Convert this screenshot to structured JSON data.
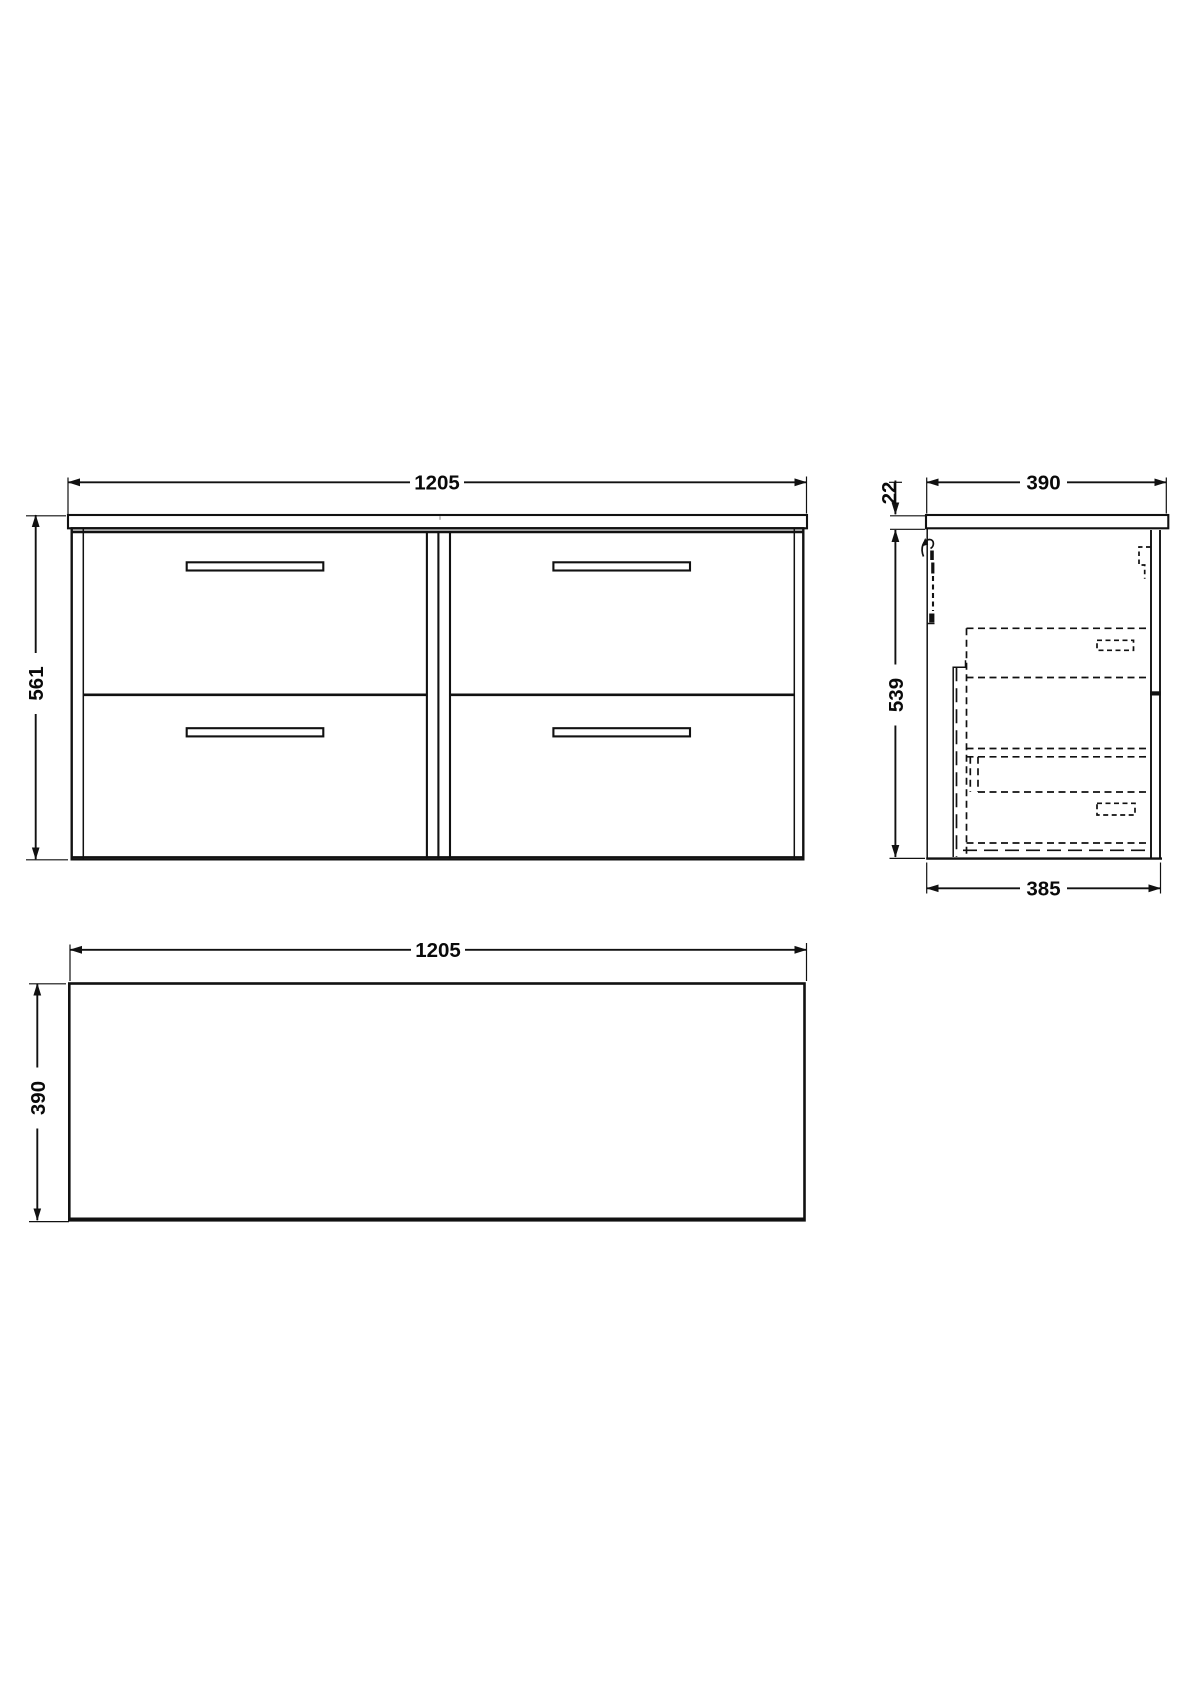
{
  "drawing": {
    "front_view": {
      "width_label": "1205",
      "height_label": "561"
    },
    "side_view": {
      "width_label": "390",
      "counter_thickness_label": "22",
      "height_label": "539",
      "depth_label": "385"
    },
    "plan_view": {
      "width_label": "1205",
      "depth_label": "390"
    },
    "colors": {
      "line": "#111111",
      "background": "#ffffff"
    }
  }
}
